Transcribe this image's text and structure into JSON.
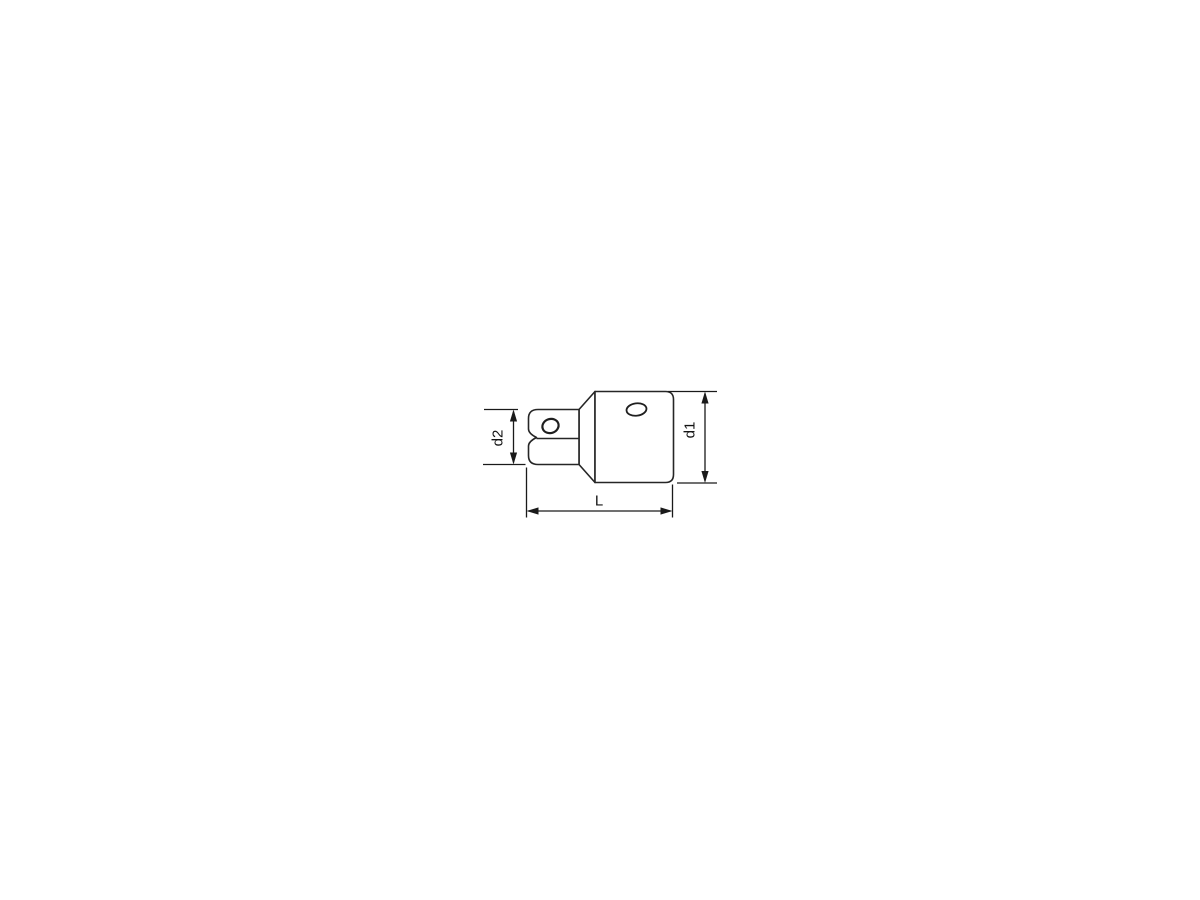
{
  "window": {
    "background": "#ffffff"
  },
  "drawing": {
    "subject": "socket adapter side view with dimension lines",
    "colors": {
      "outline": "#262626",
      "dimension_lines": "#1a1a1a",
      "label_text": "#141414",
      "background": "#ffffff"
    },
    "dimension_labels": {
      "d2": "d2",
      "d1": "d1",
      "L": "L"
    },
    "dimensions": [
      {
        "label": "d2",
        "orientation": "vertical",
        "measures": "square-drive height (left end)"
      },
      {
        "label": "d1",
        "orientation": "vertical",
        "measures": "body height (right end)"
      },
      {
        "label": "L",
        "orientation": "horizontal",
        "measures": "overall length"
      }
    ]
  }
}
